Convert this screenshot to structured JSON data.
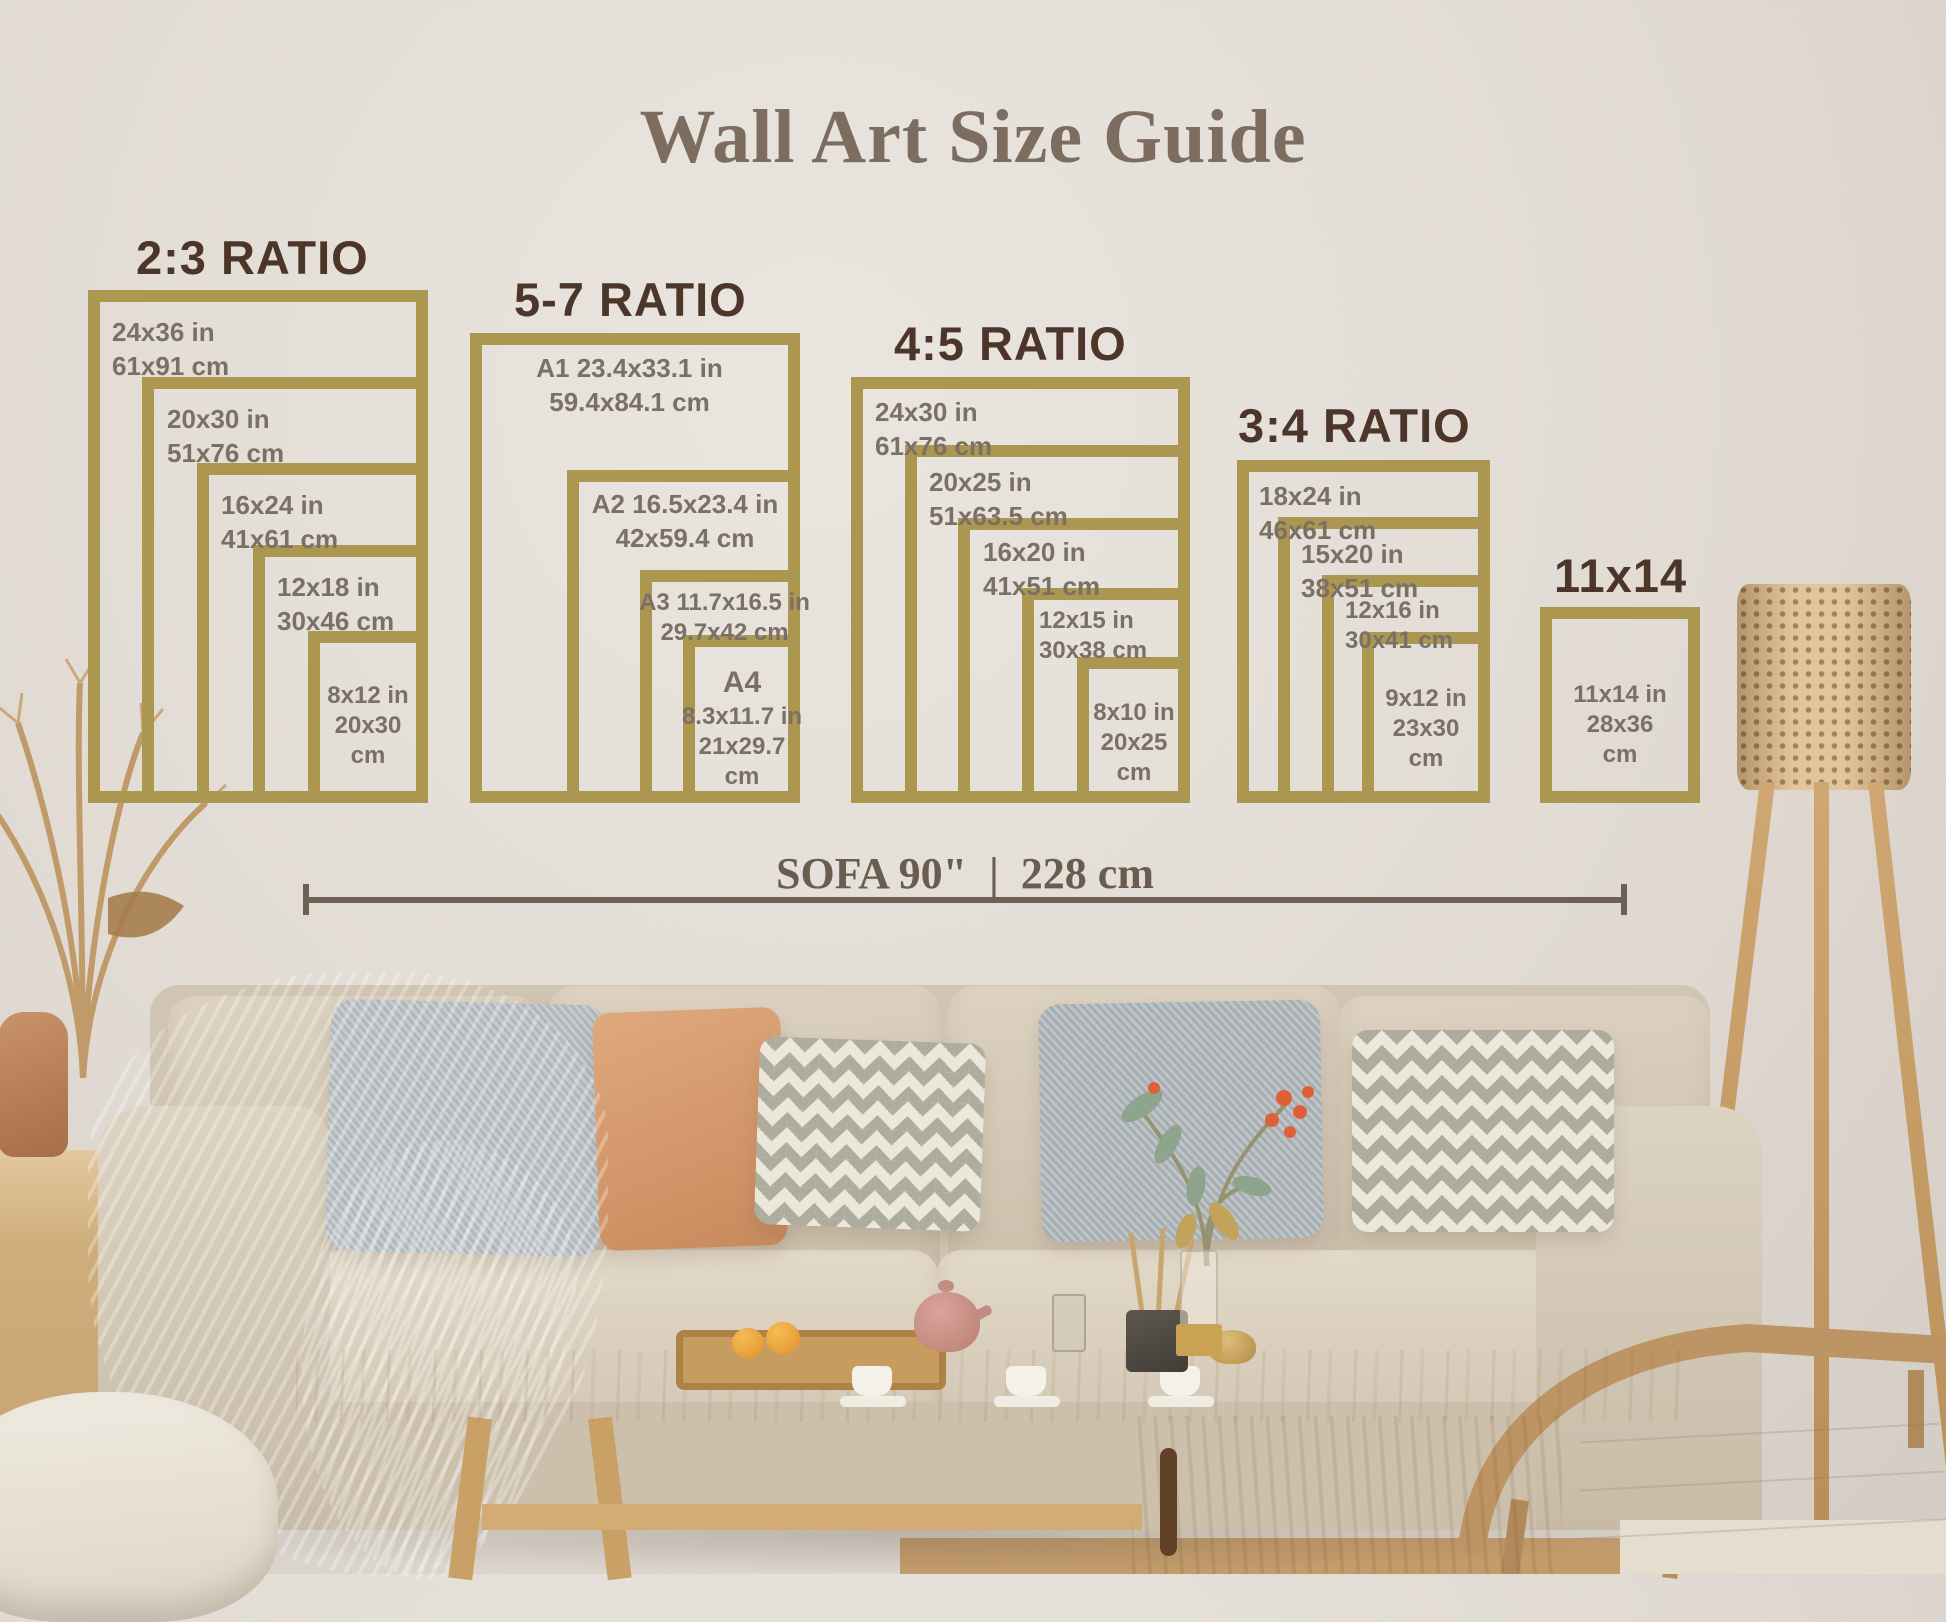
{
  "title": "Wall Art Size Guide",
  "groups": [
    {
      "header": "2:3 RATIO",
      "frames": [
        {
          "line1": "24x36 in",
          "line2": "61x91 cm"
        },
        {
          "line1": "20x30 in",
          "line2": "51x76 cm"
        },
        {
          "line1": "16x24 in",
          "line2": "41x61 cm"
        },
        {
          "line1": "12x18 in",
          "line2": "30x46 cm"
        },
        {
          "line1": "8x12 in",
          "line2": "20x30",
          "line3": "cm"
        }
      ]
    },
    {
      "header": "5-7 RATIO",
      "frames": [
        {
          "line1": "A1 23.4x33.1 in",
          "line2": "59.4x84.1 cm"
        },
        {
          "line1": "A2 16.5x23.4 in",
          "line2": "42x59.4 cm"
        },
        {
          "line1": "A3 11.7x16.5 in",
          "line2": "29.7x42 cm"
        },
        {
          "line1": "A4",
          "line2": "8.3x11.7 in",
          "line3": "21x29.7",
          "line4": "cm"
        }
      ]
    },
    {
      "header": "4:5 RATIO",
      "frames": [
        {
          "line1": "24x30 in",
          "line2": "61x76 cm"
        },
        {
          "line1": "20x25 in",
          "line2": "51x63.5 cm"
        },
        {
          "line1": "16x20 in",
          "line2": "41x51 cm"
        },
        {
          "line1": "12x15 in",
          "line2": "30x38 cm"
        },
        {
          "line1": "8x10 in",
          "line2": "20x25",
          "line3": "cm"
        }
      ]
    },
    {
      "header": "3:4 RATIO",
      "frames": [
        {
          "line1": "18x24 in",
          "line2": "46x61 cm"
        },
        {
          "line1": "15x20 in",
          "line2": "38x51 cm"
        },
        {
          "line1": "12x16 in",
          "line2": "30x41 cm"
        },
        {
          "line1": "9x12 in",
          "line2": "23x30",
          "line3": "cm"
        }
      ]
    },
    {
      "header": "11x14",
      "frames": [
        {
          "line1": "11x14 in",
          "line2": "28x36",
          "line3": "cm"
        }
      ]
    }
  ],
  "sofa_measure": {
    "label_in": "SOFA 90\"",
    "separator": "|",
    "label_cm": "228 cm"
  },
  "colors": {
    "frame_gold": "#ac9750",
    "header_brown": "#4c3529",
    "label_gray": "#7b7066",
    "title_brown": "#7d6d61",
    "measure_brown": "#6f6055"
  }
}
